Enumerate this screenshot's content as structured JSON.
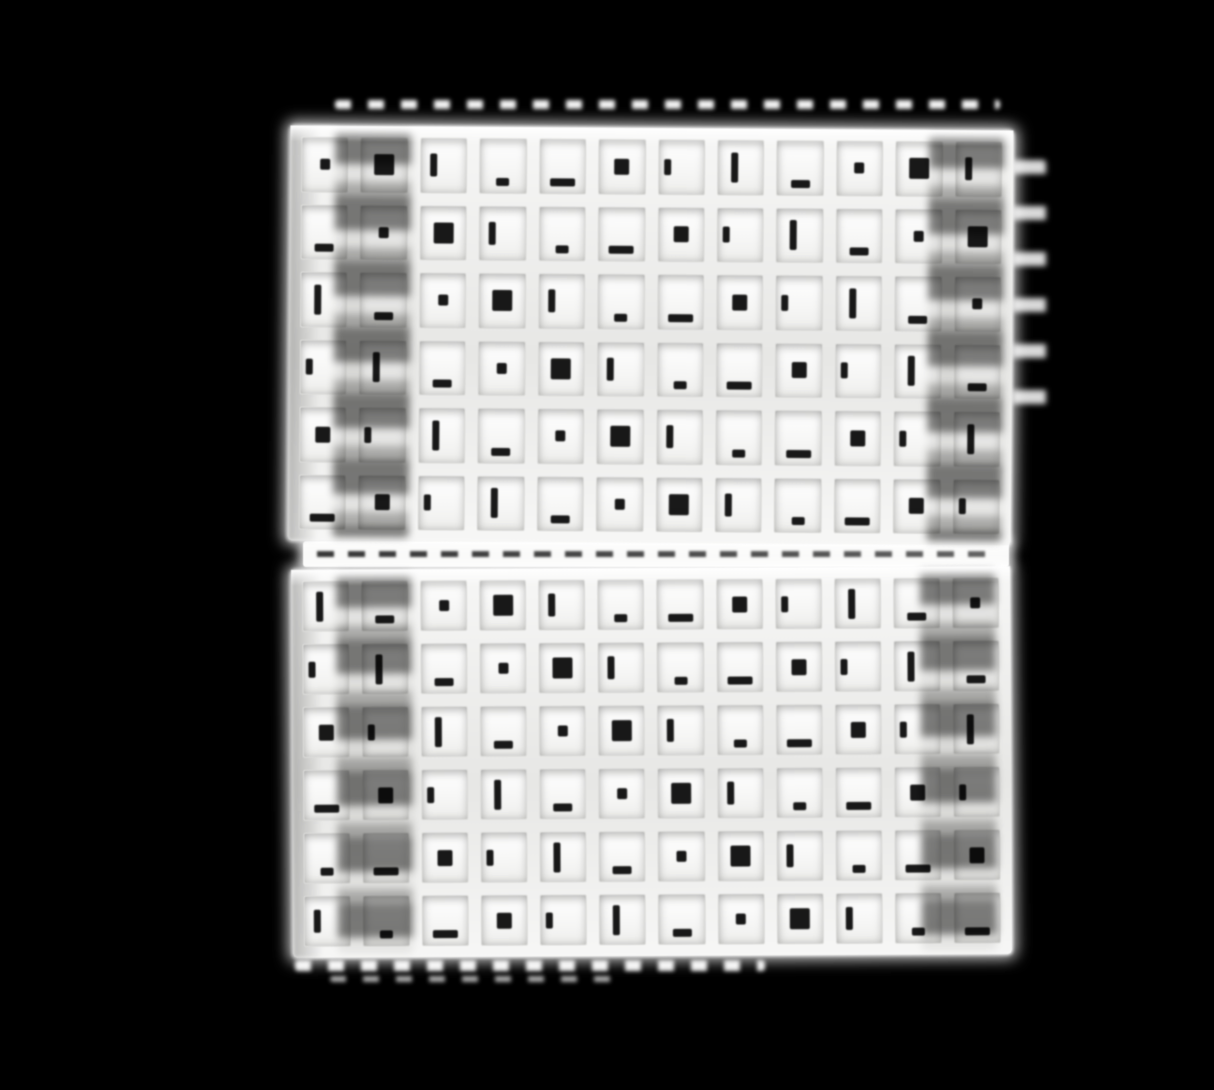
{
  "scene": {
    "description": "Close-up photograph of two white egg-crate style grid divider panels stacked vertically, viewed head-on, isolated on a black background. The square lattice cells are bright white with small black holes of background showing through; a blurred, recessed column sits in shadow near the left and right side of each panel.",
    "background_color": "#000000",
    "image": {
      "width": 1214,
      "height": 1090
    },
    "panels": [
      {
        "name": "top-grid-panel",
        "rows": 6,
        "columns": 12,
        "left": 289,
        "top": 128,
        "width": 723,
        "height": 415,
        "tilt_deg": 0.4,
        "shadow_columns": [
          0.75,
          10.6
        ]
      },
      {
        "name": "bottom-grid-panel",
        "rows": 6,
        "columns": 12,
        "left": 292,
        "top": 568,
        "width": 719,
        "height": 388,
        "tilt_deg": -0.3,
        "shadow_columns": [
          0.75,
          10.5
        ]
      }
    ],
    "colors": {
      "background_black": "#000000",
      "lattice_white": "#f7f7f6",
      "lattice_shade": "#e7e7e5",
      "strip_gray": "#b5b5b4",
      "column_shadow_dark": "#565654",
      "column_shadow_mid": "#8f8f8d",
      "hole_black": "#060606"
    }
  }
}
